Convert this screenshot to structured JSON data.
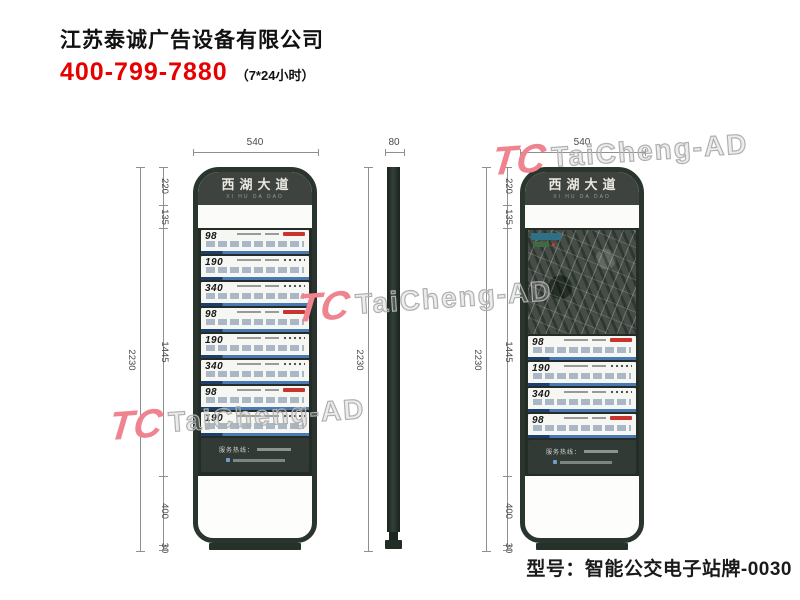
{
  "company_header": {
    "name": "江苏泰诚广告设备有限公司",
    "phone": "400-799-7880",
    "hours": "（7*24小时）"
  },
  "model_caption": "型号：智能公交电子站牌-0030",
  "watermark": {
    "logo": "TC",
    "text": "TaiCheng-AD"
  },
  "colors": {
    "frame_green": "#2a352d",
    "header_charcoal": "#3e433f",
    "phone_red": "#e60000",
    "route_red": "#c9352e",
    "route_blue": "#4a7ab5",
    "watermark_pink": "#ef8490",
    "dimension_gray": "#8f8f8f"
  },
  "stop_sign": {
    "title": "西湖大道",
    "pinyin": "XI HU DA DAO",
    "service_hotline_label": "服务热线：",
    "front_view_routes": [
      "98",
      "190",
      "340",
      "98",
      "190",
      "340",
      "98",
      "190"
    ],
    "map_view_routes": [
      "98",
      "190",
      "340",
      "98"
    ]
  },
  "dimensions": {
    "front_width": "540",
    "side_width": "80",
    "total_height": "2230",
    "segments": [
      "220",
      "135",
      "1445",
      "400",
      "30"
    ]
  }
}
